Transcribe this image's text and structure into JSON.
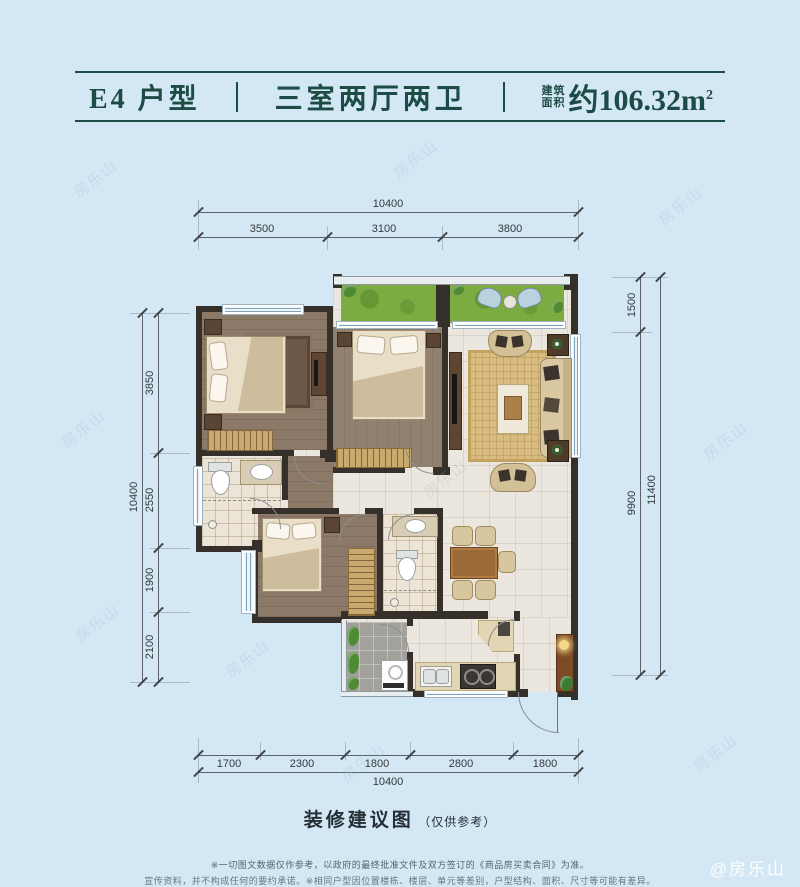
{
  "header": {
    "unit_label": "E4 户型",
    "layout_label": "三室两厅两卫",
    "area_prefix_top": "建筑",
    "area_prefix_bottom": "面积",
    "area_value": "约106.32m",
    "area_sup": "2"
  },
  "dims": {
    "top": {
      "total": "10400",
      "segments": [
        "3500",
        "3100",
        "3800"
      ]
    },
    "left": {
      "total": "10400",
      "segments": [
        "3850",
        "2550",
        "1900",
        "2100"
      ]
    },
    "right": {
      "total": "11400",
      "segments": [
        "1500",
        "9900"
      ]
    },
    "bottom": {
      "total": "10400",
      "segments": [
        "1700",
        "2300",
        "1800",
        "2800",
        "1800"
      ]
    }
  },
  "caption": {
    "title": "装修建议图",
    "note": "（仅供参考）"
  },
  "disclaimer": {
    "line1": "※一切图文数据仅作参考，以政府的最终批准文件及双方签订的《商品房买卖合同》为准。",
    "line2": "宣传资料，并不构成任何的要约承诺。※相同户型因位置楼栋、楼层、单元等差别，户型结构、面积、尺寸等可能有差异。"
  },
  "watermark": {
    "text": "房乐山",
    "credit": "@房乐山"
  },
  "colors": {
    "background": "#d3e8f4",
    "header_teal": "#1d4b46",
    "wall": "#36302b",
    "grass": "#7cab41",
    "wood": "#8d7968",
    "tile": "#ebe6de",
    "rug": "#d9bc80"
  }
}
